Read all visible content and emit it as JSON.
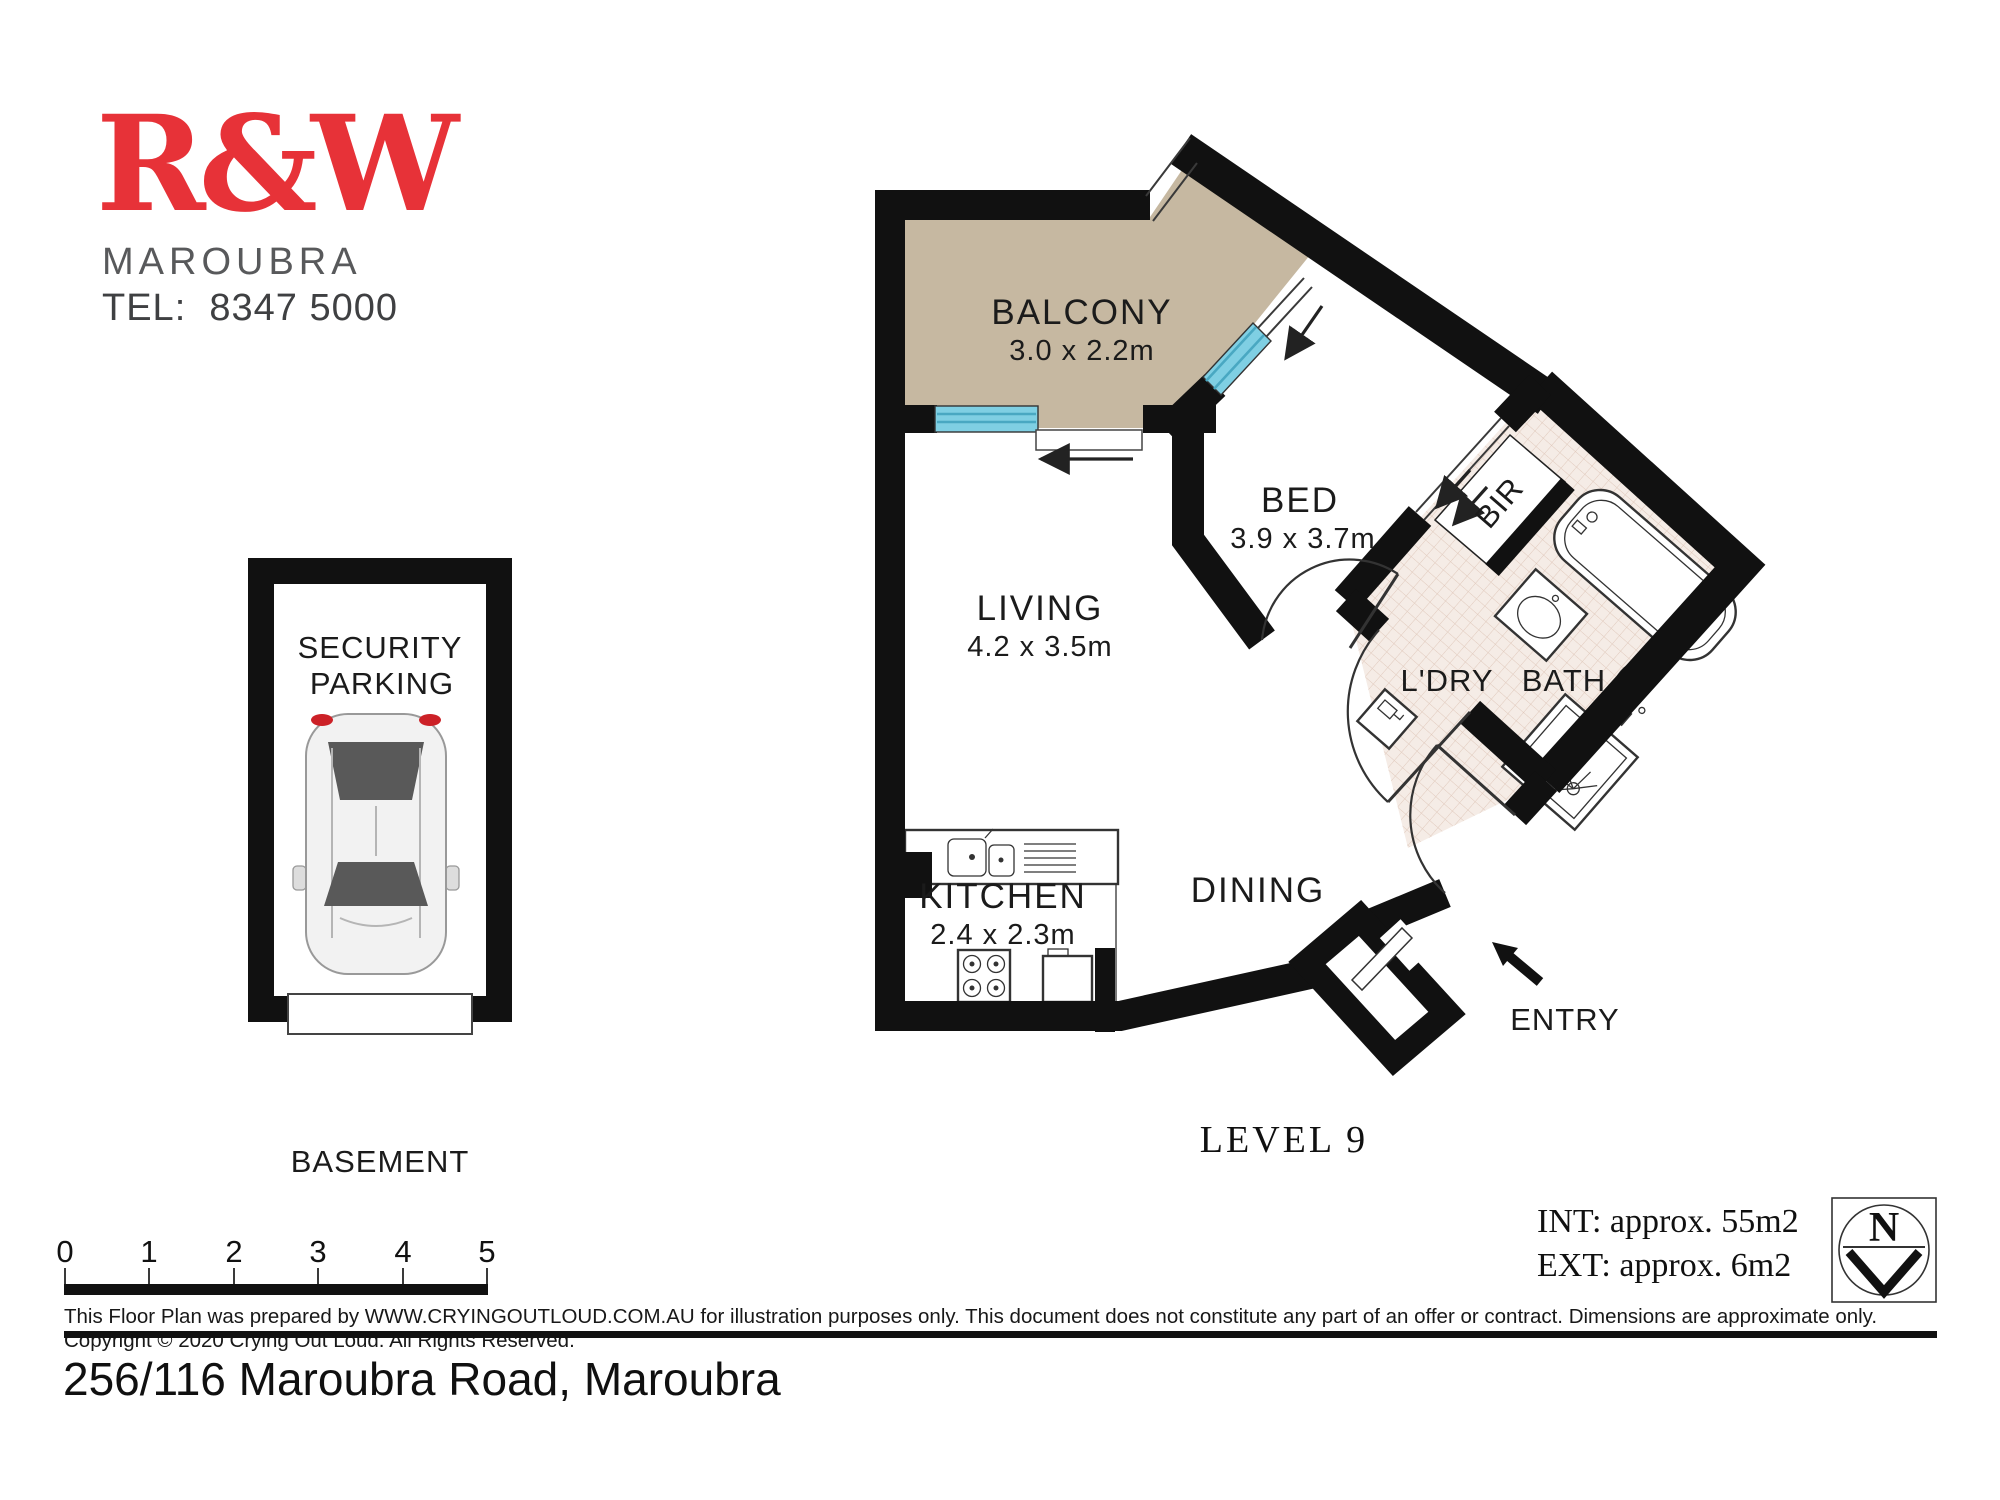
{
  "colors": {
    "brand_red": "#e73238",
    "wall": "#111111",
    "balcony_fill": "#c6b8a1",
    "window_blue": "#7fcfe3",
    "window_blue_dark": "#49a8c2",
    "tile_fill": "#f5ece6",
    "tile_line": "#e0c9bc",
    "text_dark": "#1b1b1b",
    "gray_text": "#58595b"
  },
  "logo": {
    "brand": "R&W",
    "suburb": "MAROUBRA",
    "tel": "TEL:  8347 5000"
  },
  "plan": {
    "level_label": "LEVEL 9",
    "rooms": {
      "balcony": {
        "name": "BALCONY",
        "dims": "3.0 x 2.2m"
      },
      "living": {
        "name": "LIVING",
        "dims": "4.2 x 3.5m"
      },
      "bed": {
        "name": "BED",
        "dims": "3.9 x 3.7m"
      },
      "kitchen": {
        "name": "KITCHEN",
        "dims": "2.4 x 2.3m"
      },
      "dining": {
        "name": "DINING"
      },
      "laundry": {
        "name": "L'DRY"
      },
      "bath": {
        "name": "BATH"
      },
      "robe": {
        "name": "BIR"
      },
      "entry": {
        "name": "ENTRY"
      }
    }
  },
  "parking": {
    "line1": "SECURITY",
    "line2": "PARKING",
    "caption": "BASEMENT"
  },
  "scale_bar": {
    "ticks": [
      "0",
      "1",
      "2",
      "3",
      "4",
      "5"
    ]
  },
  "areas": {
    "internal": "INT: approx. 55m2",
    "external": "EXT: approx. 6m2"
  },
  "compass": {
    "north": "N"
  },
  "footer": {
    "disclaimer": "This Floor Plan was prepared by WWW.CRYINGOUTLOUD.COM.AU for illustration purposes only. This document does not constitute any part of an offer or contract. Dimensions are approximate only. Copyright © 2020 Crying Out Loud. All Rights Reserved.",
    "address": "256/116 Maroubra Road, Maroubra"
  }
}
